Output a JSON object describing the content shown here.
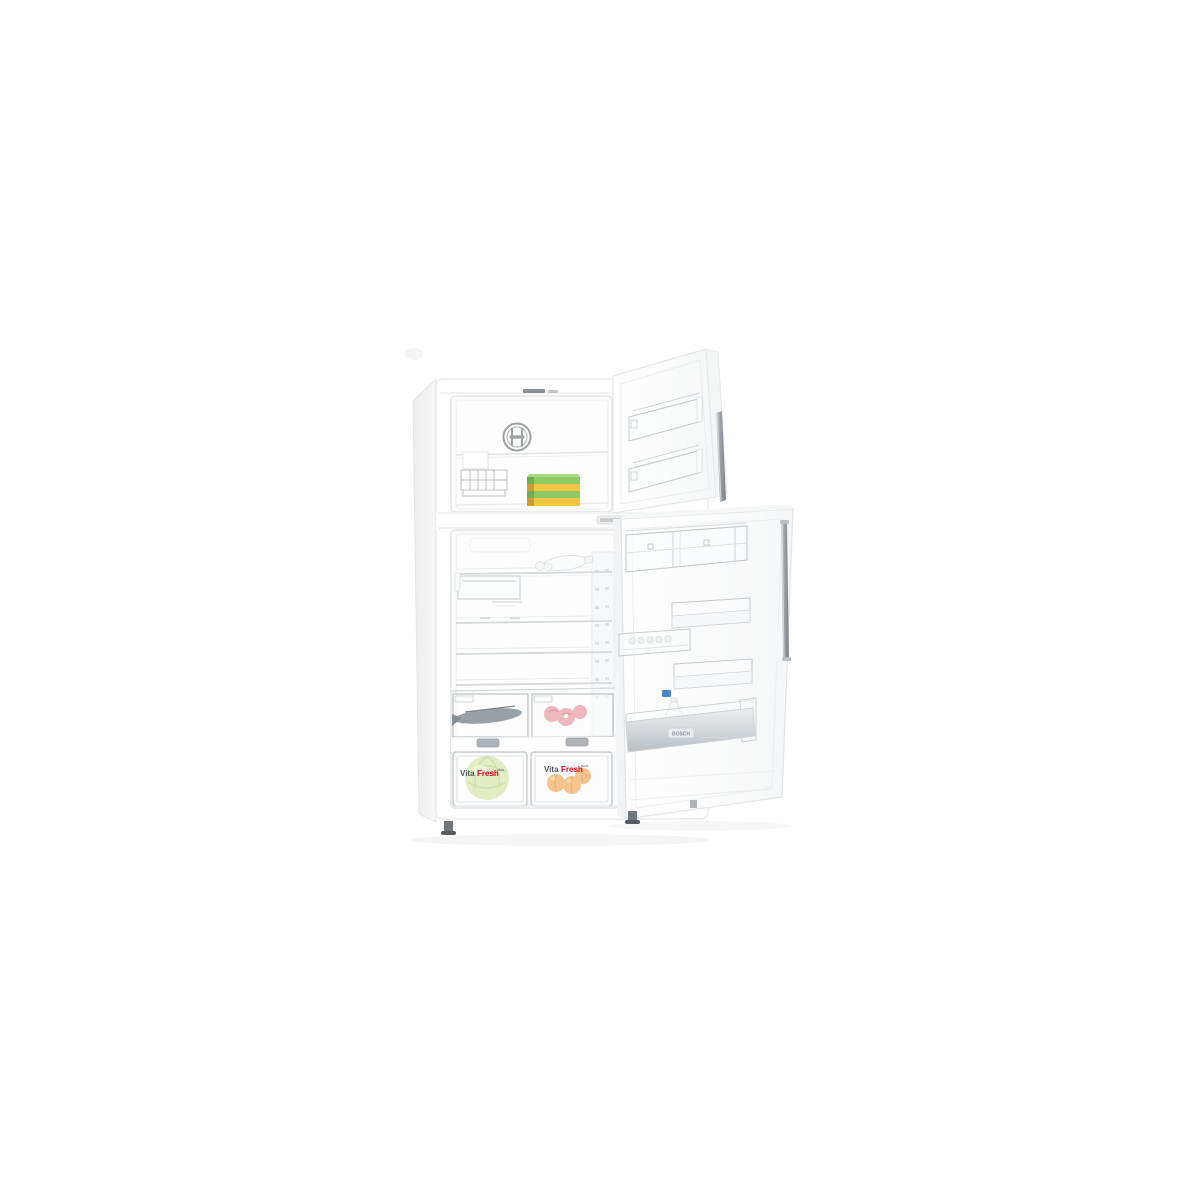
{
  "background": "#ffffff",
  "brand": {
    "badge_text": "BOSCH",
    "emblem": "bosch-circle-armature-emblem"
  },
  "labels": {
    "vitafresh_left": {
      "vita": "Vita",
      "fresh": "Fresh",
      "suffix": "plus"
    },
    "vitafresh_right": {
      "vita": "Vita",
      "fresh": "Fresh",
      "suffix": "plus"
    }
  },
  "colors": {
    "box_green": "#8fca67",
    "box_green_top": "#a8d886",
    "box_green_end": "#6fae4e",
    "box_yellow": "#f4c641",
    "box_yellow_end": "#cf9a2e",
    "cabbage_green": "#cade92",
    "cabbage_vein": "#aec96e",
    "apricot_orange": "#ef9430",
    "apricot_shade": "#d1761d",
    "fish_gray": "#98a0a6",
    "meat_pink": "#eeb7bd",
    "meat_marble": "#e29aa4",
    "vita_gray": "#4d565c",
    "fresh_red": "#e2001a",
    "handle_silver": "#878e93",
    "bottle_cap_blue": "#4a86c8",
    "emblem_gray": "#9da0a2"
  },
  "objects": {
    "freezer_items": [
      "frozen-food-boxes",
      "ice-cube-tray"
    ],
    "fridge_items": [
      "water-bottle",
      "fish",
      "meat-cuts",
      "cabbage",
      "apricots"
    ],
    "door_features": [
      "dairy-compartment",
      "door-shelves",
      "egg-tray",
      "bottom-bottle-bin"
    ]
  }
}
